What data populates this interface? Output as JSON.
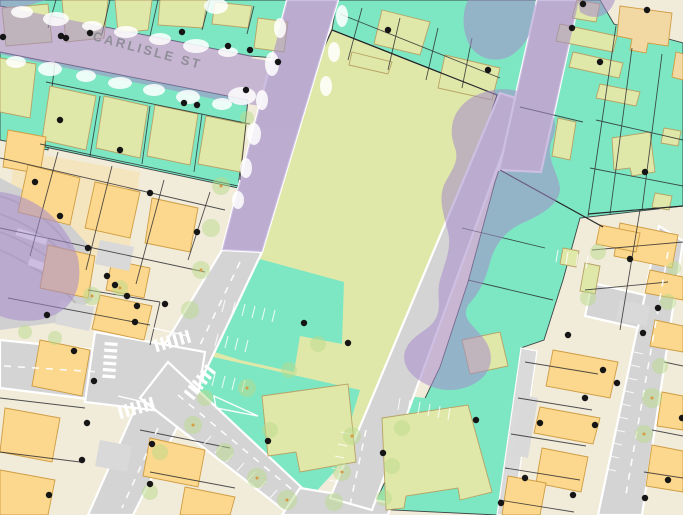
{
  "map": {
    "street_label": "CARLISLE ST",
    "colors": {
      "parcel_teal": "#7de7c3",
      "building_green": "#e0e8a9",
      "building_yellow": "#fbd88d",
      "building_tan": "#f2d9a4",
      "building_tan_outline": "#cf9c43",
      "building_green_outline": "#b7a265",
      "parcel_cream": "#f1ebd9",
      "road_gray": "#d4d4d4",
      "lane_gray": "#dadada",
      "overlay_purple": "#a58bcc",
      "tree_green": "#b9da8c",
      "tree_center": "#d79a43",
      "boundary_ink": "#26262b",
      "address_dot": "#151515",
      "label_gray": "#8a8a94",
      "marking_white": "#ffffff"
    },
    "legend": [
      {
        "icon": "parcel-teal-swatch",
        "meaning": "teal parcel"
      },
      {
        "icon": "building-green-swatch",
        "meaning": "green building"
      },
      {
        "icon": "building-yellow-swatch",
        "meaning": "yellow building"
      },
      {
        "icon": "purple-overlay-swatch",
        "meaning": "purple overlay"
      },
      {
        "icon": "tree-icon",
        "meaning": "street tree"
      },
      {
        "icon": "address-point-icon",
        "meaning": "address point"
      }
    ]
  }
}
